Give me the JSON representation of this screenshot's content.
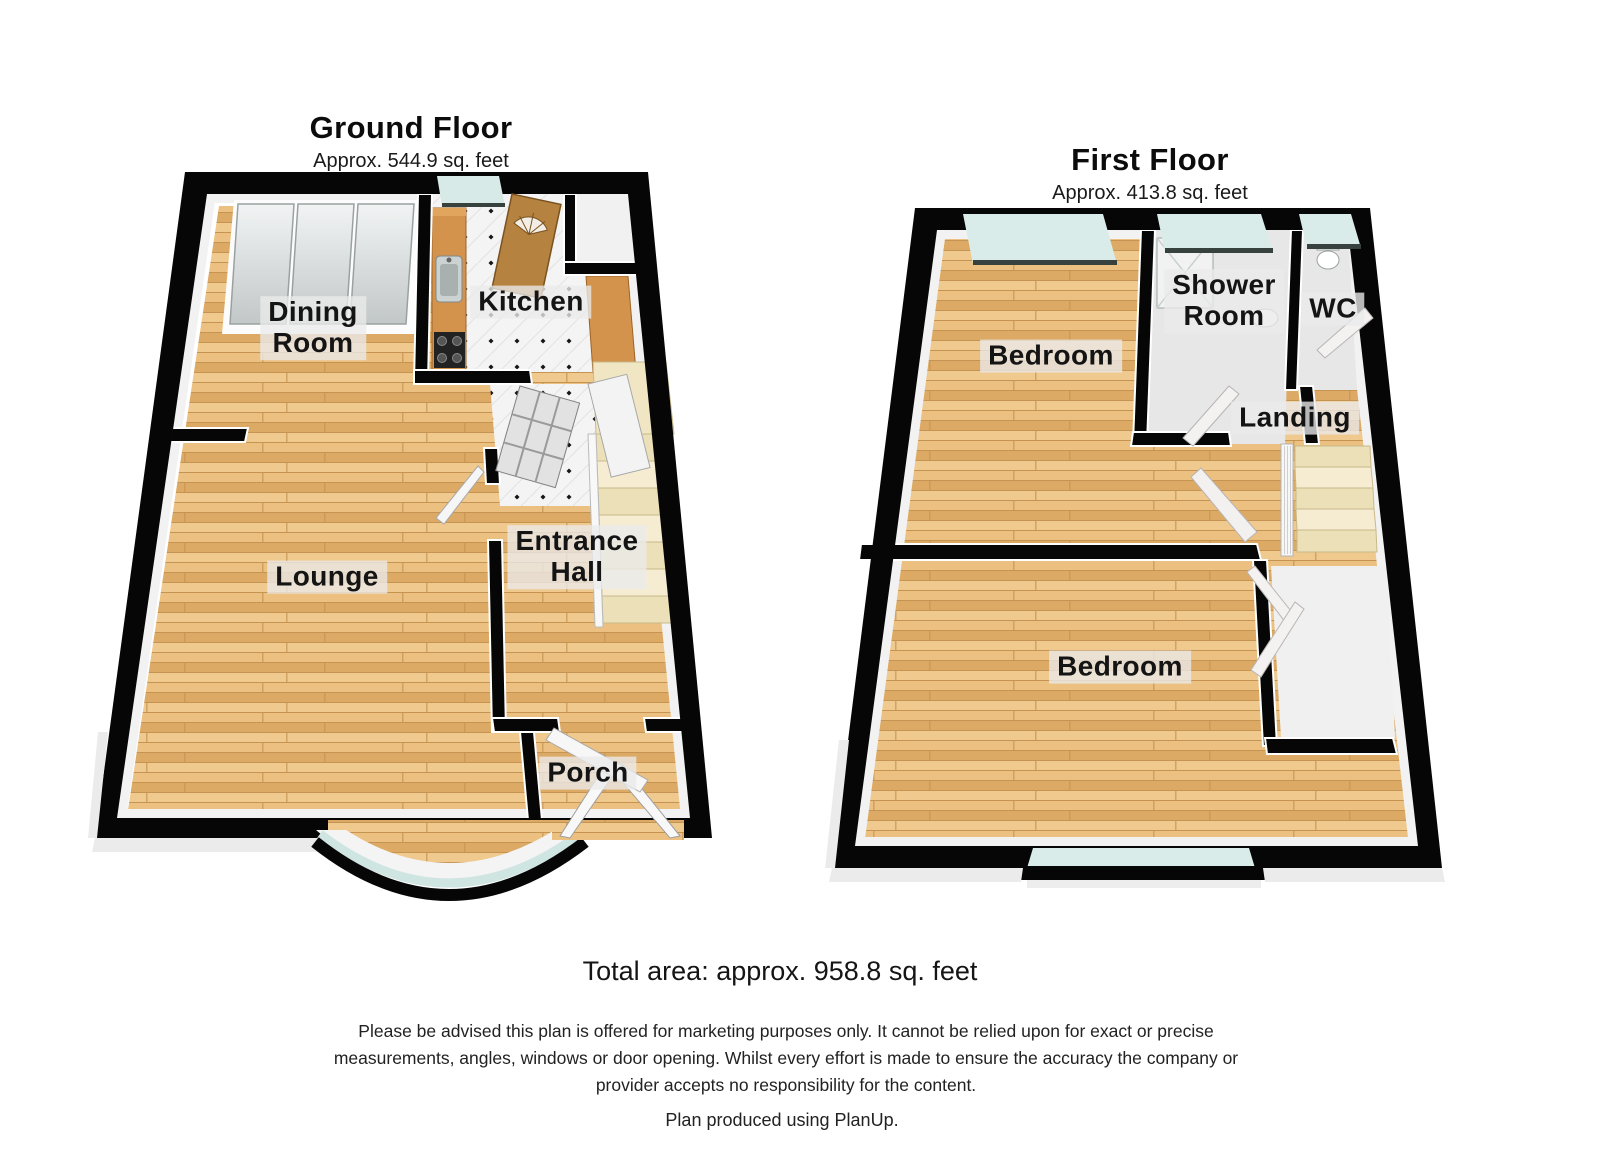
{
  "ground_floor": {
    "title": "Ground Floor",
    "subtitle": "Approx. 544.9 sq. feet",
    "rooms": {
      "dining": "Dining\nRoom",
      "kitchen": "Kitchen",
      "lounge": "Lounge",
      "hall": "Entrance\nHall",
      "porch": "Porch"
    }
  },
  "first_floor": {
    "title": "First Floor",
    "subtitle": "Approx. 413.8 sq. feet",
    "rooms": {
      "bedroom1": "Bedroom",
      "shower": "Shower\nRoom",
      "wc": "WC",
      "landing": "Landing",
      "bedroom2": "Bedroom"
    }
  },
  "footer": {
    "total_area": "Total area: approx. 958.8 sq. feet",
    "disclaimer": "Please be advised this plan is offered for marketing purposes only. It cannot be relied upon for exact or precise measurements, angles, windows or door opening. Whilst every effort is made to ensure the accuracy the company or provider accepts no responsibility for the content.",
    "credit": "Plan produced using PlanUp."
  },
  "colors": {
    "wall": "#060606",
    "wood_light": "#efc98e",
    "wood_mid": "#e4b474",
    "wood_dark": "#c69452",
    "glass": "#d7eae7",
    "counter": "#d3934c",
    "stairs": "#ece0b8",
    "label_bg": "#eaeaea",
    "label_text": "#141414"
  }
}
